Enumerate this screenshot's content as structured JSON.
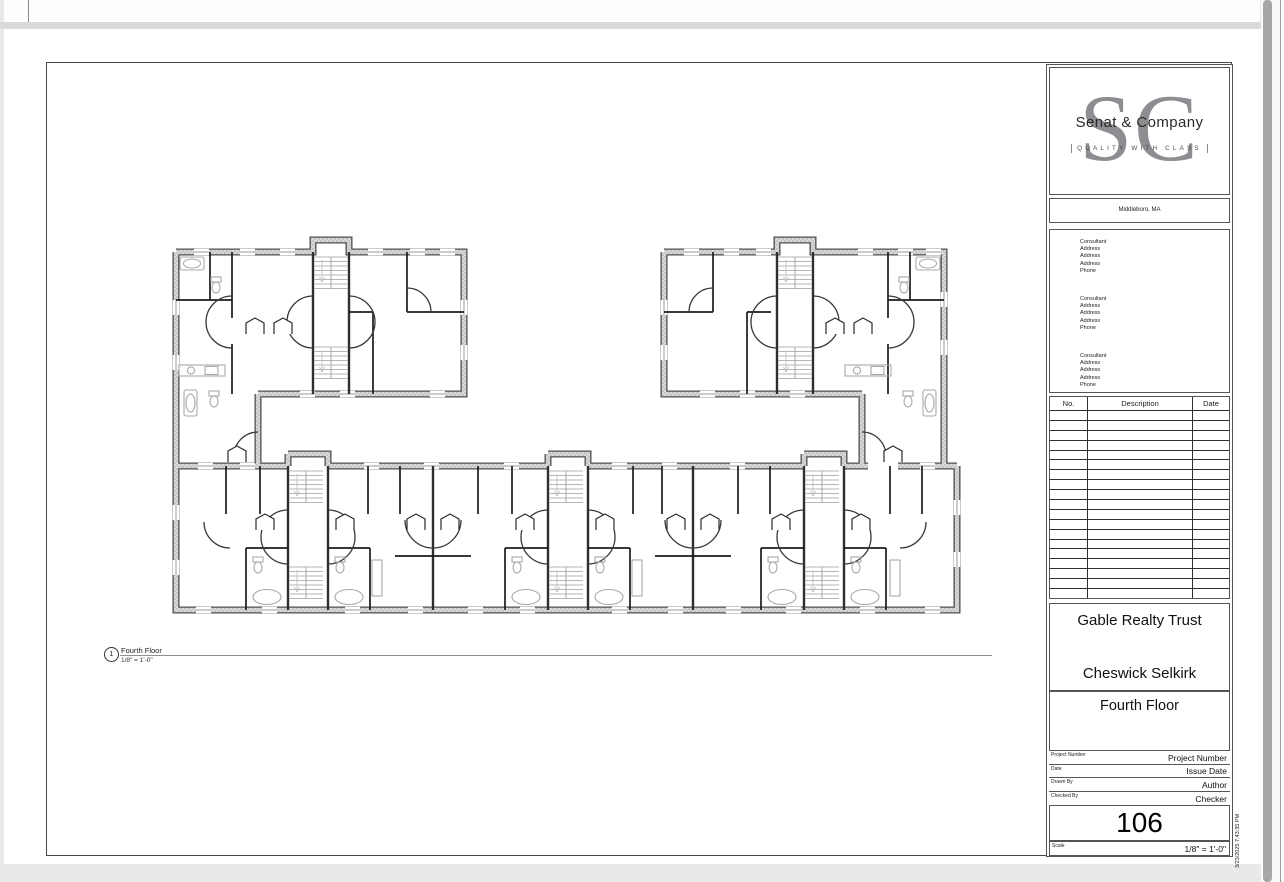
{
  "viewer": {
    "scrollbar": "vertical"
  },
  "sheet": {
    "view_title": {
      "number": "1",
      "name": "Fourth Floor",
      "scale": "1/8\" = 1'-0\""
    },
    "title_block": {
      "logo": {
        "monogram": "SC",
        "company": "Senat & Company",
        "tagline": "QUALITY WITH CLASS",
        "location": "Middleboro, MA"
      },
      "consultants": [
        [
          "Consultant",
          "Address",
          "Address",
          "Address",
          "Phone"
        ],
        [
          "Consultant",
          "Address",
          "Address",
          "Address",
          "Phone"
        ],
        [
          "Consultant",
          "Address",
          "Address",
          "Address",
          "Phone"
        ]
      ],
      "revision_table": {
        "headers": [
          "No.",
          "Description",
          "Date"
        ],
        "empty_rows": 19
      },
      "client": "Gable Realty Trust",
      "project": "Cheswick Selkirk",
      "sheet_name": "Fourth Floor",
      "fields": [
        {
          "label": "Project Number",
          "value": "Project Number"
        },
        {
          "label": "Date",
          "value": "Issue Date"
        },
        {
          "label": "Drawn By",
          "value": "Author"
        },
        {
          "label": "Checked By",
          "value": "Checker"
        }
      ],
      "sheet_number": "106",
      "scale_label": "Scale",
      "scale_value": "1/8\" = 1'-0\"",
      "timestamp": "3/23/2025 7:43:35 PM"
    }
  }
}
